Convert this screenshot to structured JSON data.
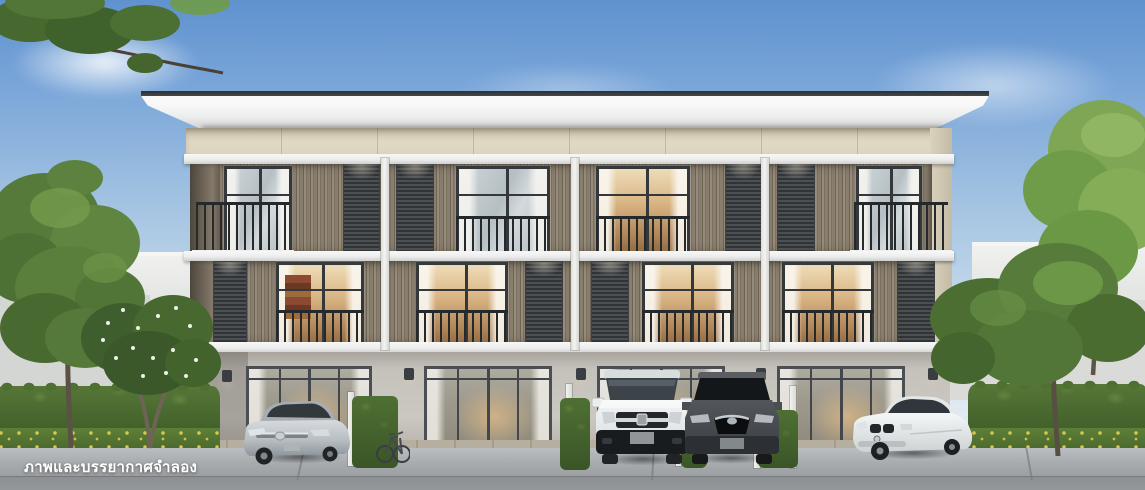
{
  "watermark": {
    "text": "ภาพและบรรยากาศจำลอง"
  },
  "palette": {
    "sky_top": "#5f92cf",
    "sky_mid": "#a9c7e3",
    "sky_horizon": "#eef2f4",
    "roof": "#36393c",
    "fascia": "#eceded",
    "cream_band": "#e0d8c3",
    "slat_brown": "#84796a",
    "louver_gray": "#4d5053",
    "window_frame": "#35383b",
    "warm_interior": "#d9b483",
    "ground_wall": "#cbc8c1",
    "ledge_white": "#eceded",
    "hedge_green": "#49682f",
    "flower_yellow": "#d9c94e",
    "tree_green": "#567a3a",
    "concrete": "#a6aaac",
    "road": "#8c9093",
    "car_silver": "#c7ccd0",
    "car_white": "#eff1f1",
    "car_gray": "#4a4e52",
    "watermark_color": "#ffffff"
  }
}
